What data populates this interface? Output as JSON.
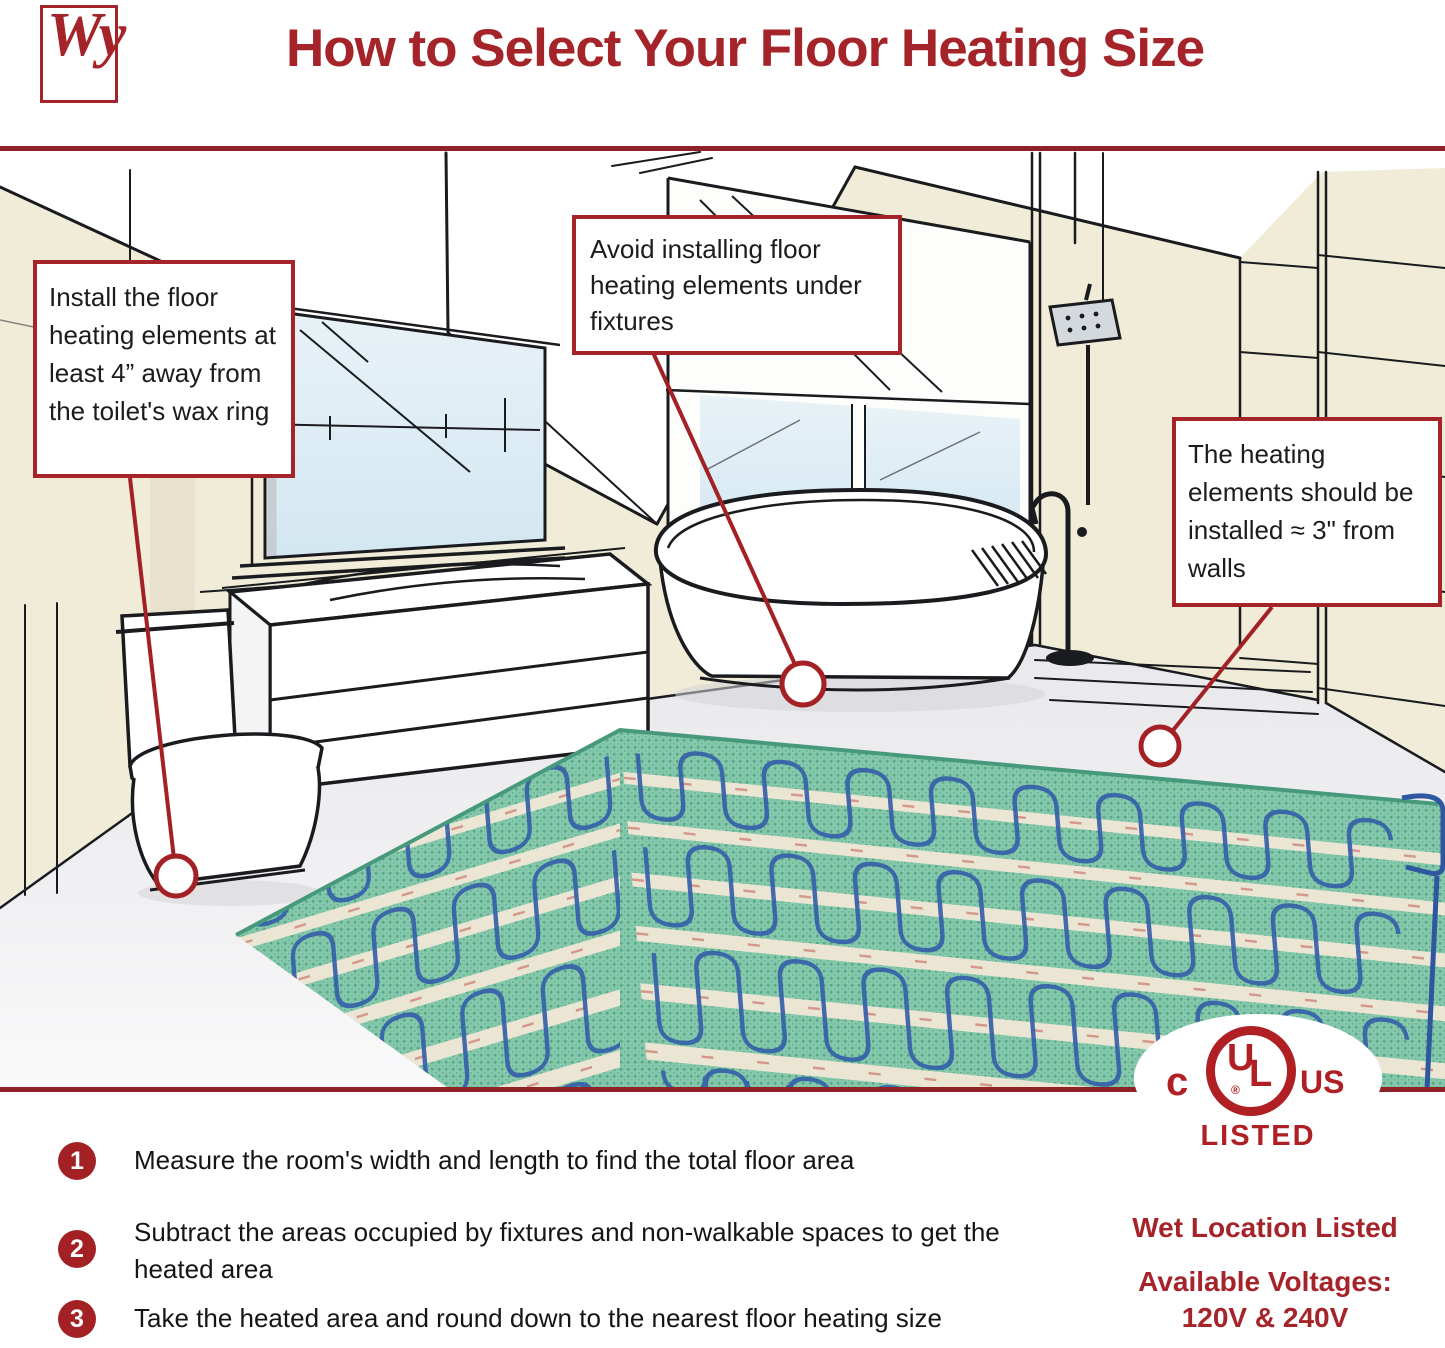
{
  "header": {
    "logo_text": "Wy",
    "title": "How to Select Your Floor Heating Size"
  },
  "callouts": [
    {
      "id": "toilet",
      "text": "Install the floor heating elements at least 4” away from the toilet's wax ring"
    },
    {
      "id": "fixtures",
      "text": "Avoid installing floor heating elements under fixtures"
    },
    {
      "id": "walls",
      "text": "The heating elements should be installed ≈ 3\" from walls"
    }
  ],
  "steps": [
    {
      "number": "1",
      "text": "Measure the room's width and length to find the total floor area"
    },
    {
      "number": "2",
      "text": "Subtract the areas occupied by fixtures and non-walkable spaces to get the heated area"
    },
    {
      "number": "3",
      "text": "Take the heated area and round down to the nearest floor heating size"
    }
  ],
  "certification": {
    "ul_prefix": "c",
    "ul_letter_u": "U",
    "ul_letter_l": "L",
    "ul_registered": "®",
    "ul_suffix": "US",
    "listed": "LISTED",
    "wet_location": "Wet Location Listed",
    "voltages_label": "Available Voltages:",
    "voltages_value": "120V & 240V"
  },
  "colors": {
    "accent_red": "#A5242A",
    "rule_red": "#8F2127",
    "badge_red": "#A32025",
    "wall_cream": "#F1ECD8",
    "glass_blue": "#DCEBF3",
    "mat_green": "#82C6A9",
    "mat_strip": "#EBE5D4",
    "cable_blue": "#3560A8",
    "text_black": "#1C1C1C"
  }
}
